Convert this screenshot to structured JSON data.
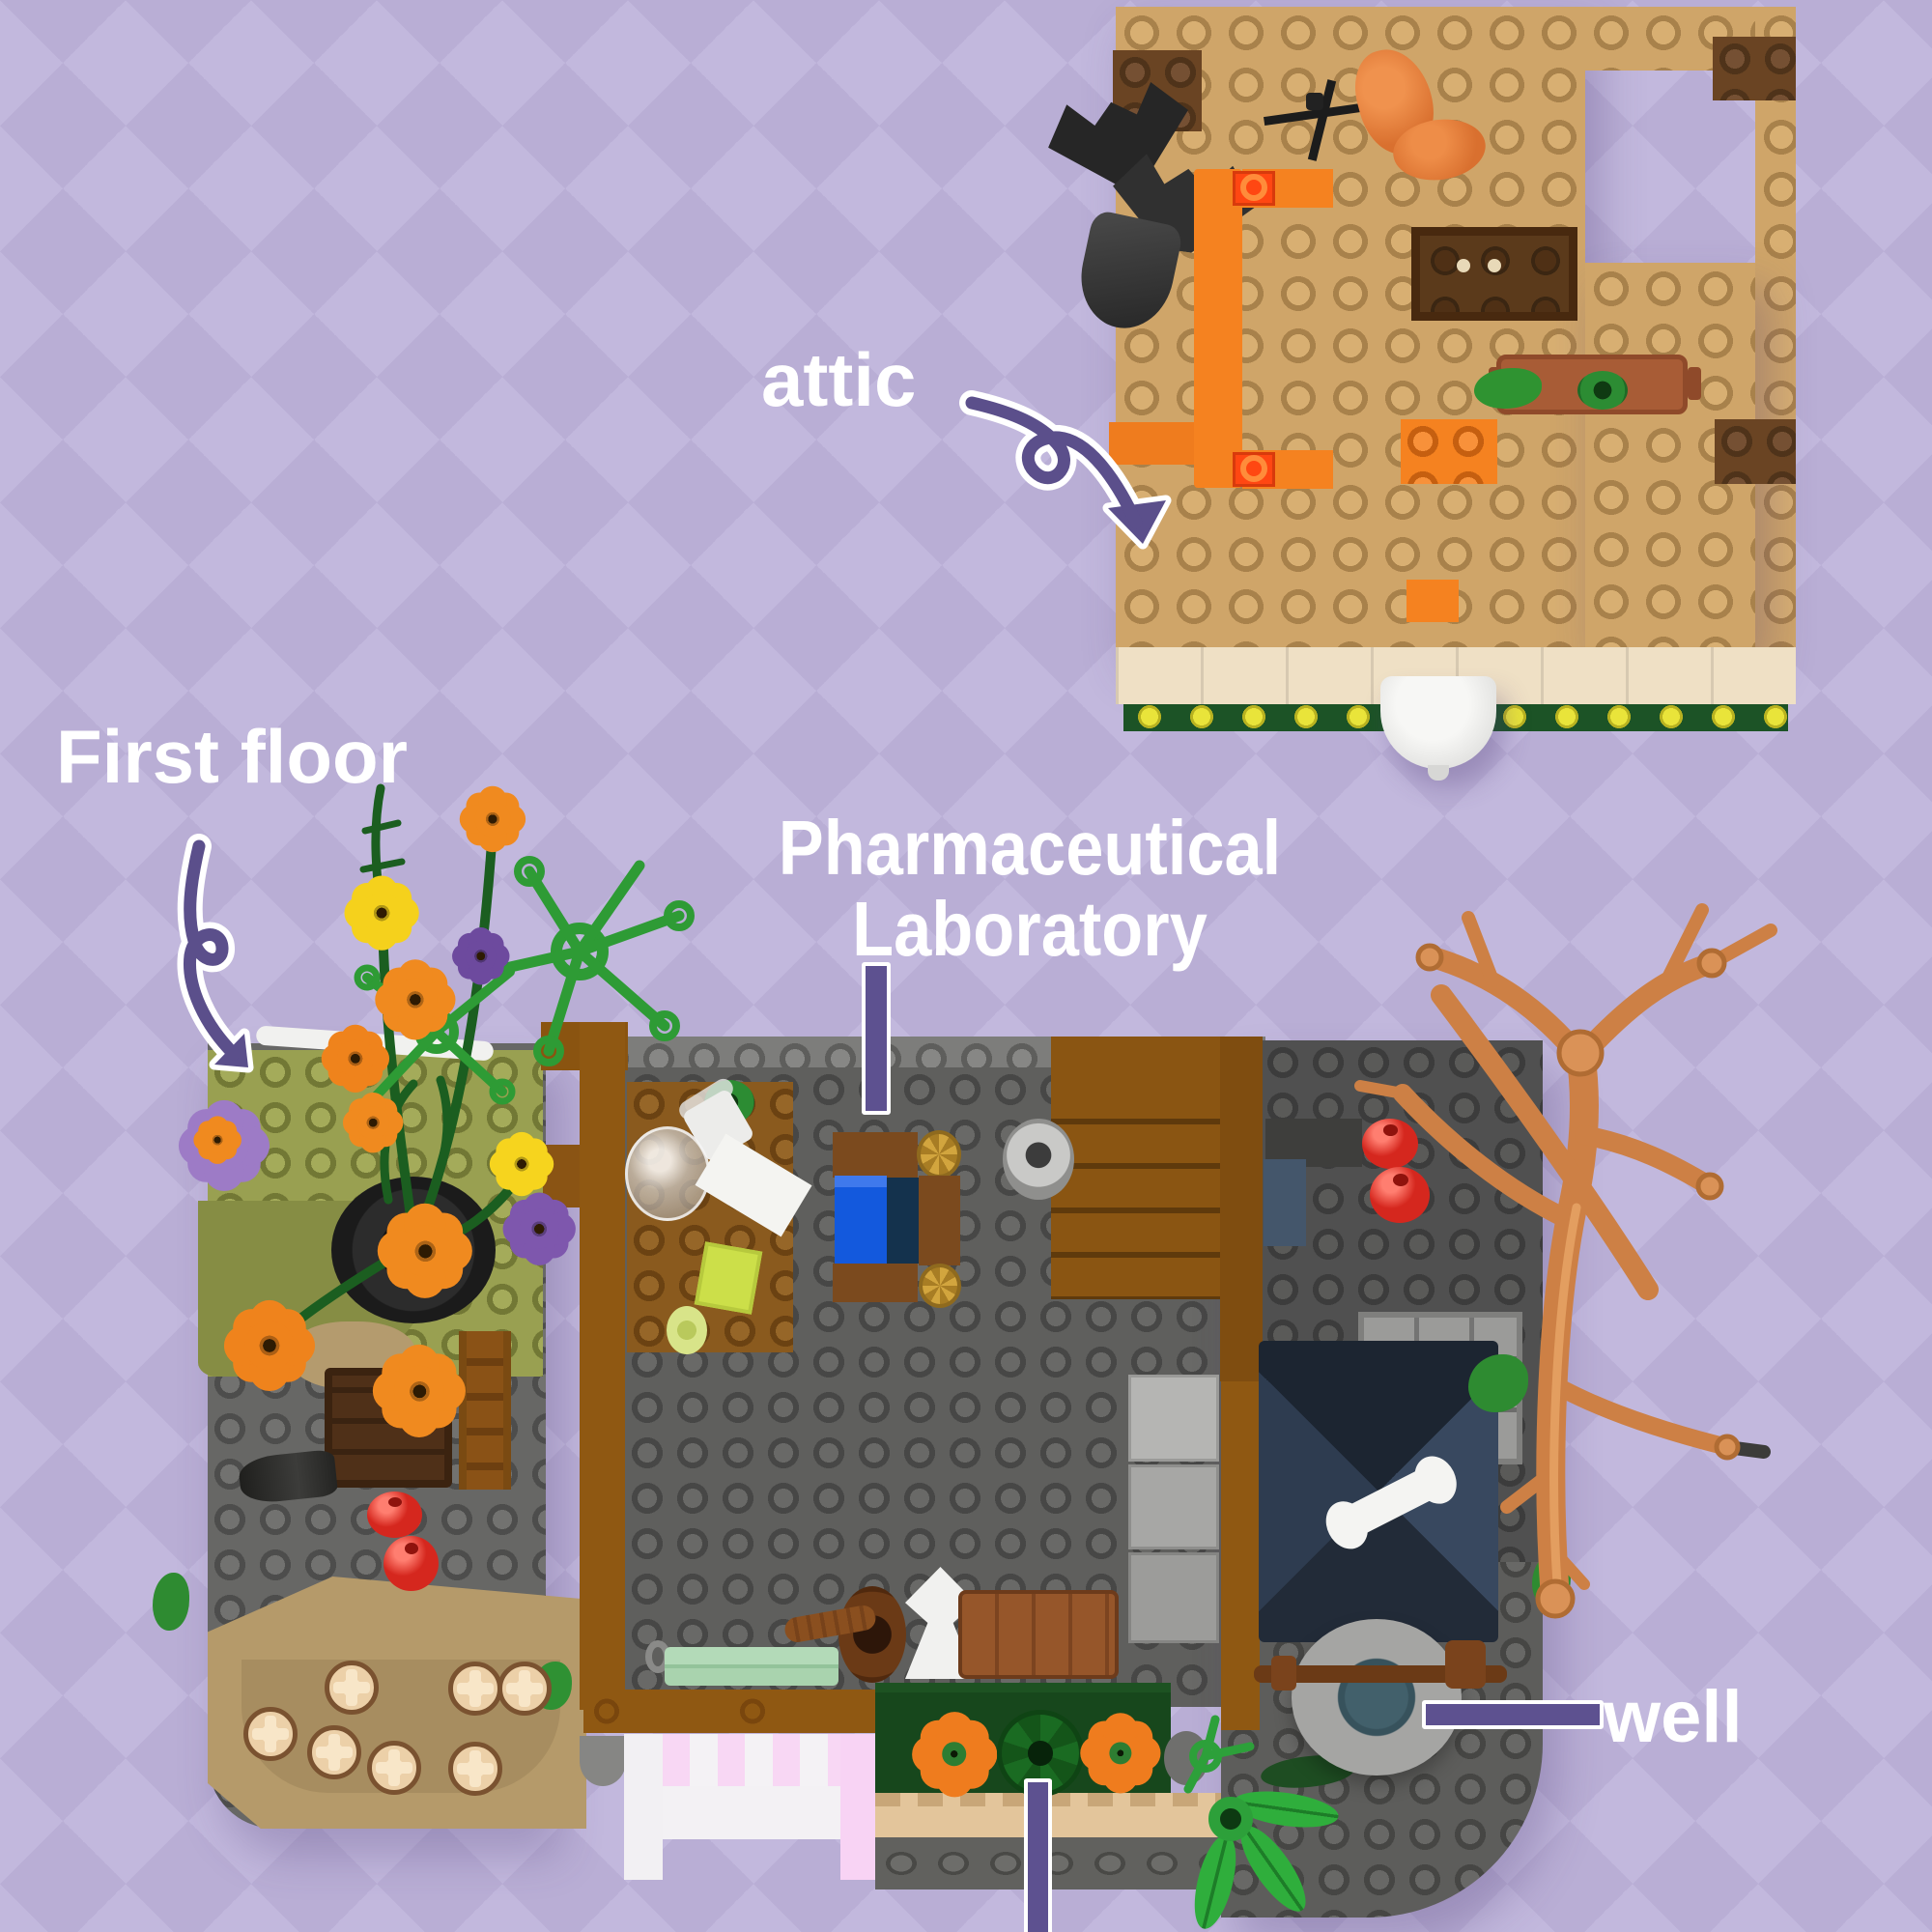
{
  "annotations": {
    "attic": {
      "text": "attic",
      "pointer": "curved-arrow"
    },
    "first_floor": {
      "text": "First floor",
      "pointer": "curved-arrow"
    },
    "laboratory": {
      "text_line1": "Pharmaceutical",
      "text_line2": "Laboratory",
      "pointer": "straight-line-down"
    },
    "well": {
      "text": "well",
      "pointer": "straight-line-left"
    },
    "market_stand": {
      "text": "",
      "pointer": "straight-line-up-cropped"
    }
  },
  "palette": {
    "background": "#b9aed5",
    "background_light": "#c2b8dd",
    "annotation_purple": "#5b4f8b",
    "label_text": "#ffffff",
    "attic_plate_tan": "#cfa569",
    "brick_brown": "#6a4423",
    "bench_orange": "#f58220",
    "main_plate_gray": "#676765",
    "wall_brown": "#8f5812",
    "garden_olive": "#99a051",
    "awning_pink": "#f8d7f4",
    "pumpkin_orange": "#ef7c1e",
    "tree_nougat": "#cd8045",
    "well_water_teal": "#42606b",
    "blanket_blue": "#1359dd",
    "roof_navy": "#2e3c50"
  }
}
